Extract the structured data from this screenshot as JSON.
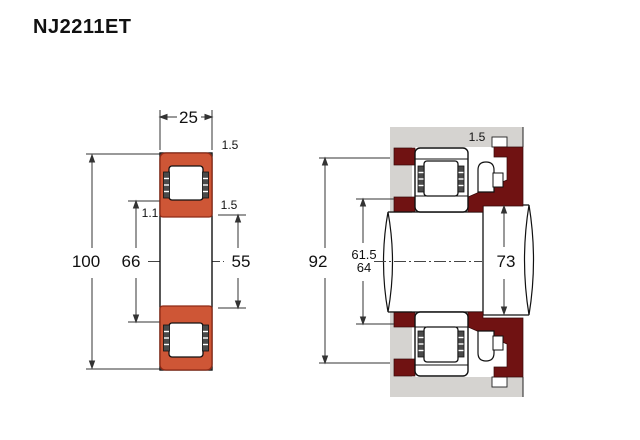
{
  "title": "NJ2211ET",
  "colors": {
    "bearing_orange": "#ce5636",
    "bearing_orange_edge": "#8e2a16",
    "collar_maroon": "#701212",
    "housing_gray": "#d5d3d0",
    "line": "#111111"
  },
  "left_view": {
    "label": "bearing-cross-section",
    "dims": {
      "width": "25",
      "outer_chamfer": "1.5",
      "inner_chamfer": "1.5",
      "rib_chamfer": "1.1",
      "outer_diameter": "100",
      "rib_diameter": "66",
      "bore_diameter": "55"
    }
  },
  "right_view": {
    "label": "mounted-arrangement",
    "dims": {
      "housing_abutment_diameter": "92",
      "shaft_abutment_upper": "61.5",
      "shaft_abutment_lower": "64",
      "shaft_shoulder_diameter": "73",
      "groove_width": "1.5"
    }
  }
}
